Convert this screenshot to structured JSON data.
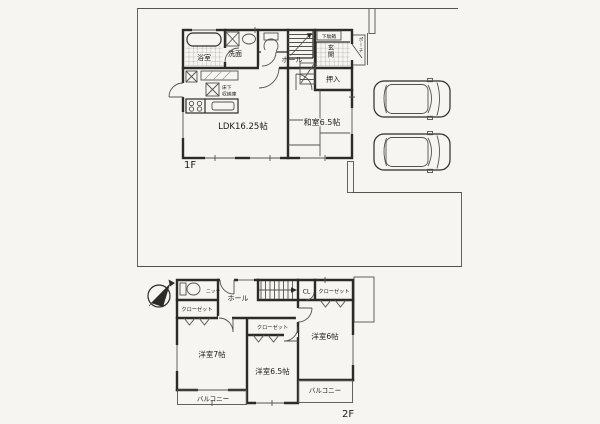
{
  "meta": {
    "floor1_label": "1F",
    "floor2_label": "2F"
  },
  "floor1": {
    "bath": "浴室",
    "washroom": "洗面",
    "hall": "ホール",
    "shoebox": "下駄箱",
    "genkan": "玄関",
    "porch": "ポーチ",
    "oshiire": "押入",
    "washitsu": "和室6.5帖",
    "ldk": "LDK16.25帖",
    "underfloor_line1": "床下",
    "underfloor_line2": "収納庫"
  },
  "floor2": {
    "niche": "ニッチ",
    "closet_nw": "クローゼット",
    "hall": "ホール",
    "cl": "CL",
    "closet_ne": "クローゼット",
    "closet_mid": "クローゼット",
    "room_west": "洋室7帖",
    "room_mid": "洋室6.5帖",
    "room_east": "洋室6帖",
    "balcony_west": "バルコニー",
    "balcony_east": "バルコニー"
  },
  "colors": {
    "paper": "#f6f5f2",
    "wall": "#2d2b28",
    "thin": "#55524c",
    "hatch": "#8f8d86",
    "ink": "#1c1b19"
  }
}
